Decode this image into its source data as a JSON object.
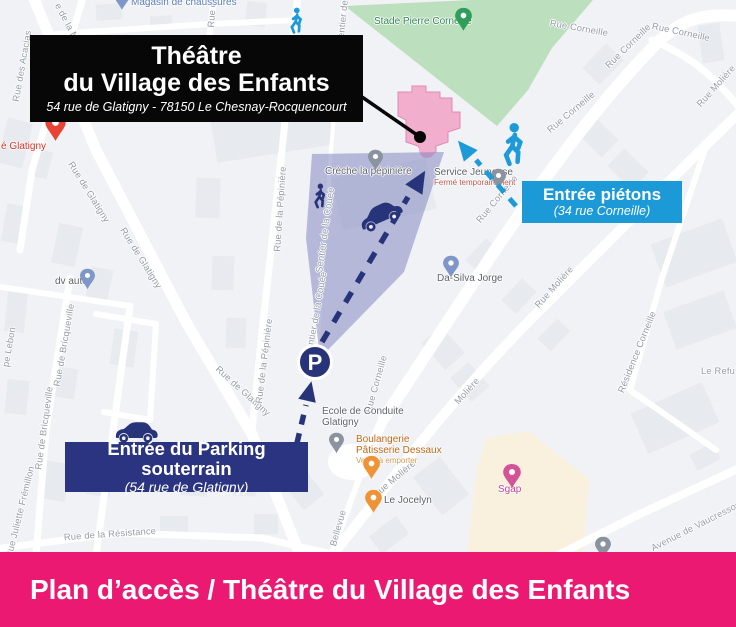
{
  "banner": {
    "text": "Plan d’accès / Théâtre du Village des Enfants"
  },
  "title_box": {
    "line1": "Théâtre",
    "line2": "du Village des Enfants",
    "address": "54 rue de Glatigny - 78150 Le Chesnay-Rocquencourt"
  },
  "pedestrian_box": {
    "line1": "Entrée piétons",
    "line2": "(34 rue Corneille)"
  },
  "parking_box": {
    "line1": "Entrée du Parking souterrain",
    "line2": "(54 rue de Glatigny)"
  },
  "parking_marker_label": "P",
  "colors": {
    "banner_pink": "#EC1973",
    "box_black": "#070707",
    "box_blue": "#1B9AD7",
    "box_navy": "#2A3480",
    "route_blue": "#1D9BD8",
    "route_navy": "#283479",
    "park_green": "#BCDFBE",
    "theatre_pink": "#F2AECD",
    "zone_purple": "rgba(122,126,188,0.5)",
    "commercial_beige": "#F9F1DD"
  },
  "map": {
    "street_labels": [
      {
        "text": "Rue des Acacias",
        "x": 22,
        "y": 66,
        "rot": -80
      },
      {
        "text": "e de la Ma",
        "x": 68,
        "y": 24,
        "rot": 62
      },
      {
        "text": "Rue de",
        "x": 212,
        "y": 12,
        "rot": -86
      },
      {
        "text": "Sentier de la",
        "x": 343,
        "y": 17,
        "rot": -84
      },
      {
        "text": "Rue de Glatigny",
        "x": 89,
        "y": 192,
        "rot": 58
      },
      {
        "text": "Rue de Glatigny",
        "x": 141,
        "y": 258,
        "rot": 58
      },
      {
        "text": "Rue de Glatigny",
        "x": 243,
        "y": 391,
        "rot": 42
      },
      {
        "text": "Rue de Bricqueville",
        "x": 64,
        "y": 345,
        "rot": -80
      },
      {
        "text": "Rue de Bricqueville",
        "x": 44,
        "y": 428,
        "rot": -82
      },
      {
        "text": "Rue Juliette Frémillon",
        "x": 20,
        "y": 512,
        "rot": -76
      },
      {
        "text": "pe Lebon",
        "x": 9,
        "y": 347,
        "rot": -80
      },
      {
        "text": "Rue de la Résistance",
        "x": 110,
        "y": 534,
        "rot": -4
      },
      {
        "text": "Bellevue",
        "x": 338,
        "y": 528,
        "rot": -74
      },
      {
        "text": "Rue de la Pépinière",
        "x": 280,
        "y": 209,
        "rot": -86
      },
      {
        "text": "Rue de la Pépinière",
        "x": 264,
        "y": 361,
        "rot": -83
      },
      {
        "text": "Sentier de la Couée",
        "x": 325,
        "y": 230,
        "rot": -82
      },
      {
        "text": "Sentier de la Couée",
        "x": 316,
        "y": 314,
        "rot": -80
      },
      {
        "text": "Rue Corneille",
        "x": 579,
        "y": 28,
        "rot": 10
      },
      {
        "text": "Rue Corneille",
        "x": 628,
        "y": 46,
        "rot": -44
      },
      {
        "text": "Rue Corneille",
        "x": 681,
        "y": 32,
        "rot": 12
      },
      {
        "text": "Rue Corneille",
        "x": 571,
        "y": 112,
        "rot": -40
      },
      {
        "text": "Rue Corneille",
        "x": 497,
        "y": 199,
        "rot": -50
      },
      {
        "text": "Rue Corneille",
        "x": 376,
        "y": 384,
        "rot": -74
      },
      {
        "text": "Rue Molière",
        "x": 716,
        "y": 86,
        "rot": -48
      },
      {
        "text": "Rue Molière",
        "x": 554,
        "y": 287,
        "rot": -48
      },
      {
        "text": "Molière",
        "x": 467,
        "y": 391,
        "rot": -48
      },
      {
        "text": "Rue Molière",
        "x": 394,
        "y": 479,
        "rot": -40
      },
      {
        "text": "Résidence Corneille",
        "x": 637,
        "y": 352,
        "rot": -68
      },
      {
        "text": "Avenue de Vaucresson",
        "x": 696,
        "y": 526,
        "rot": -27
      },
      {
        "text": "Le Refu",
        "x": 718,
        "y": 371,
        "rot": 0
      }
    ],
    "poi_labels": [
      {
        "lines": [
          "Magasin de chaussures"
        ],
        "x": 131,
        "y": -3,
        "color": "#5B7CB8"
      },
      {
        "lines": [
          "é Glatigny"
        ],
        "x": 1,
        "y": 141,
        "color": "#D93025"
      },
      {
        "lines": [
          "Stade Pierre Corneille"
        ],
        "x": 374,
        "y": 16,
        "color": "#2F8452"
      },
      {
        "lines": [
          "Crèche la pépinière"
        ],
        "x": 325,
        "y": 166,
        "color": "#5F6368"
      },
      {
        "lines": [
          "Service Jeunesse"
        ],
        "x": 434,
        "y": 167,
        "color": "#5F6368",
        "sub": "Fermé temporairement",
        "sub_color": "#BB564A"
      },
      {
        "lines": [
          "Da-Silva Jorge"
        ],
        "x": 437,
        "y": 273,
        "color": "#5F6368"
      },
      {
        "lines": [
          "dv auto"
        ],
        "x": 55,
        "y": 276,
        "color": "#5F6368"
      },
      {
        "lines": [
          "Ecole de Conduite",
          "Glatigny"
        ],
        "x": 322,
        "y": 406,
        "color": "#5F6368"
      },
      {
        "lines": [
          "Boulangerie",
          "Pâtisserie Dessaux"
        ],
        "x": 356,
        "y": 434,
        "color": "#C06514",
        "sub": "Vente à emporter",
        "sub_color": "#D79A56"
      },
      {
        "lines": [
          "Le Jocelyn"
        ],
        "x": 384,
        "y": 495,
        "color": "#5F6368"
      },
      {
        "lines": [
          "Sgap"
        ],
        "x": 498,
        "y": 484,
        "color": "#C8418A"
      }
    ],
    "pins": [
      {
        "x": 122,
        "y": 10,
        "color": "#7E96C8",
        "scale": 0.8,
        "name": "magasin-pin"
      },
      {
        "x": 55,
        "y": 141,
        "color": "#E94335",
        "scale": 1.15,
        "name": "glatigny-pin"
      },
      {
        "x": 463,
        "y": 31,
        "color": "#2E9E5B",
        "scale": 0.95,
        "name": "stade-pin"
      },
      {
        "x": 375,
        "y": 170,
        "color": "#8A939E",
        "scale": 0.85,
        "name": "creche-pin"
      },
      {
        "x": 498,
        "y": 189,
        "color": "#8A939E",
        "scale": 0.85,
        "name": "service-pin"
      },
      {
        "x": 451,
        "y": 277,
        "color": "#7E96C8",
        "scale": 0.9,
        "name": "dasilva-pin"
      },
      {
        "x": 87,
        "y": 289,
        "color": "#7E96C8",
        "scale": 0.85,
        "name": "dvauto-pin"
      },
      {
        "x": 336,
        "y": 453,
        "color": "#8A939E",
        "scale": 0.85,
        "name": "ecole-pin"
      },
      {
        "x": 371,
        "y": 479,
        "color": "#EF9335",
        "scale": 0.95,
        "name": "boulangerie-pin"
      },
      {
        "x": 373,
        "y": 513,
        "color": "#EF9335",
        "scale": 0.95,
        "name": "jocelyn-pin"
      },
      {
        "x": 512,
        "y": 488,
        "color": "#D45397",
        "scale": 1.0,
        "name": "sgap-pin"
      },
      {
        "x": 603,
        "y": 558,
        "color": "#8A939E",
        "scale": 0.9,
        "name": "garage-pin"
      }
    ]
  }
}
